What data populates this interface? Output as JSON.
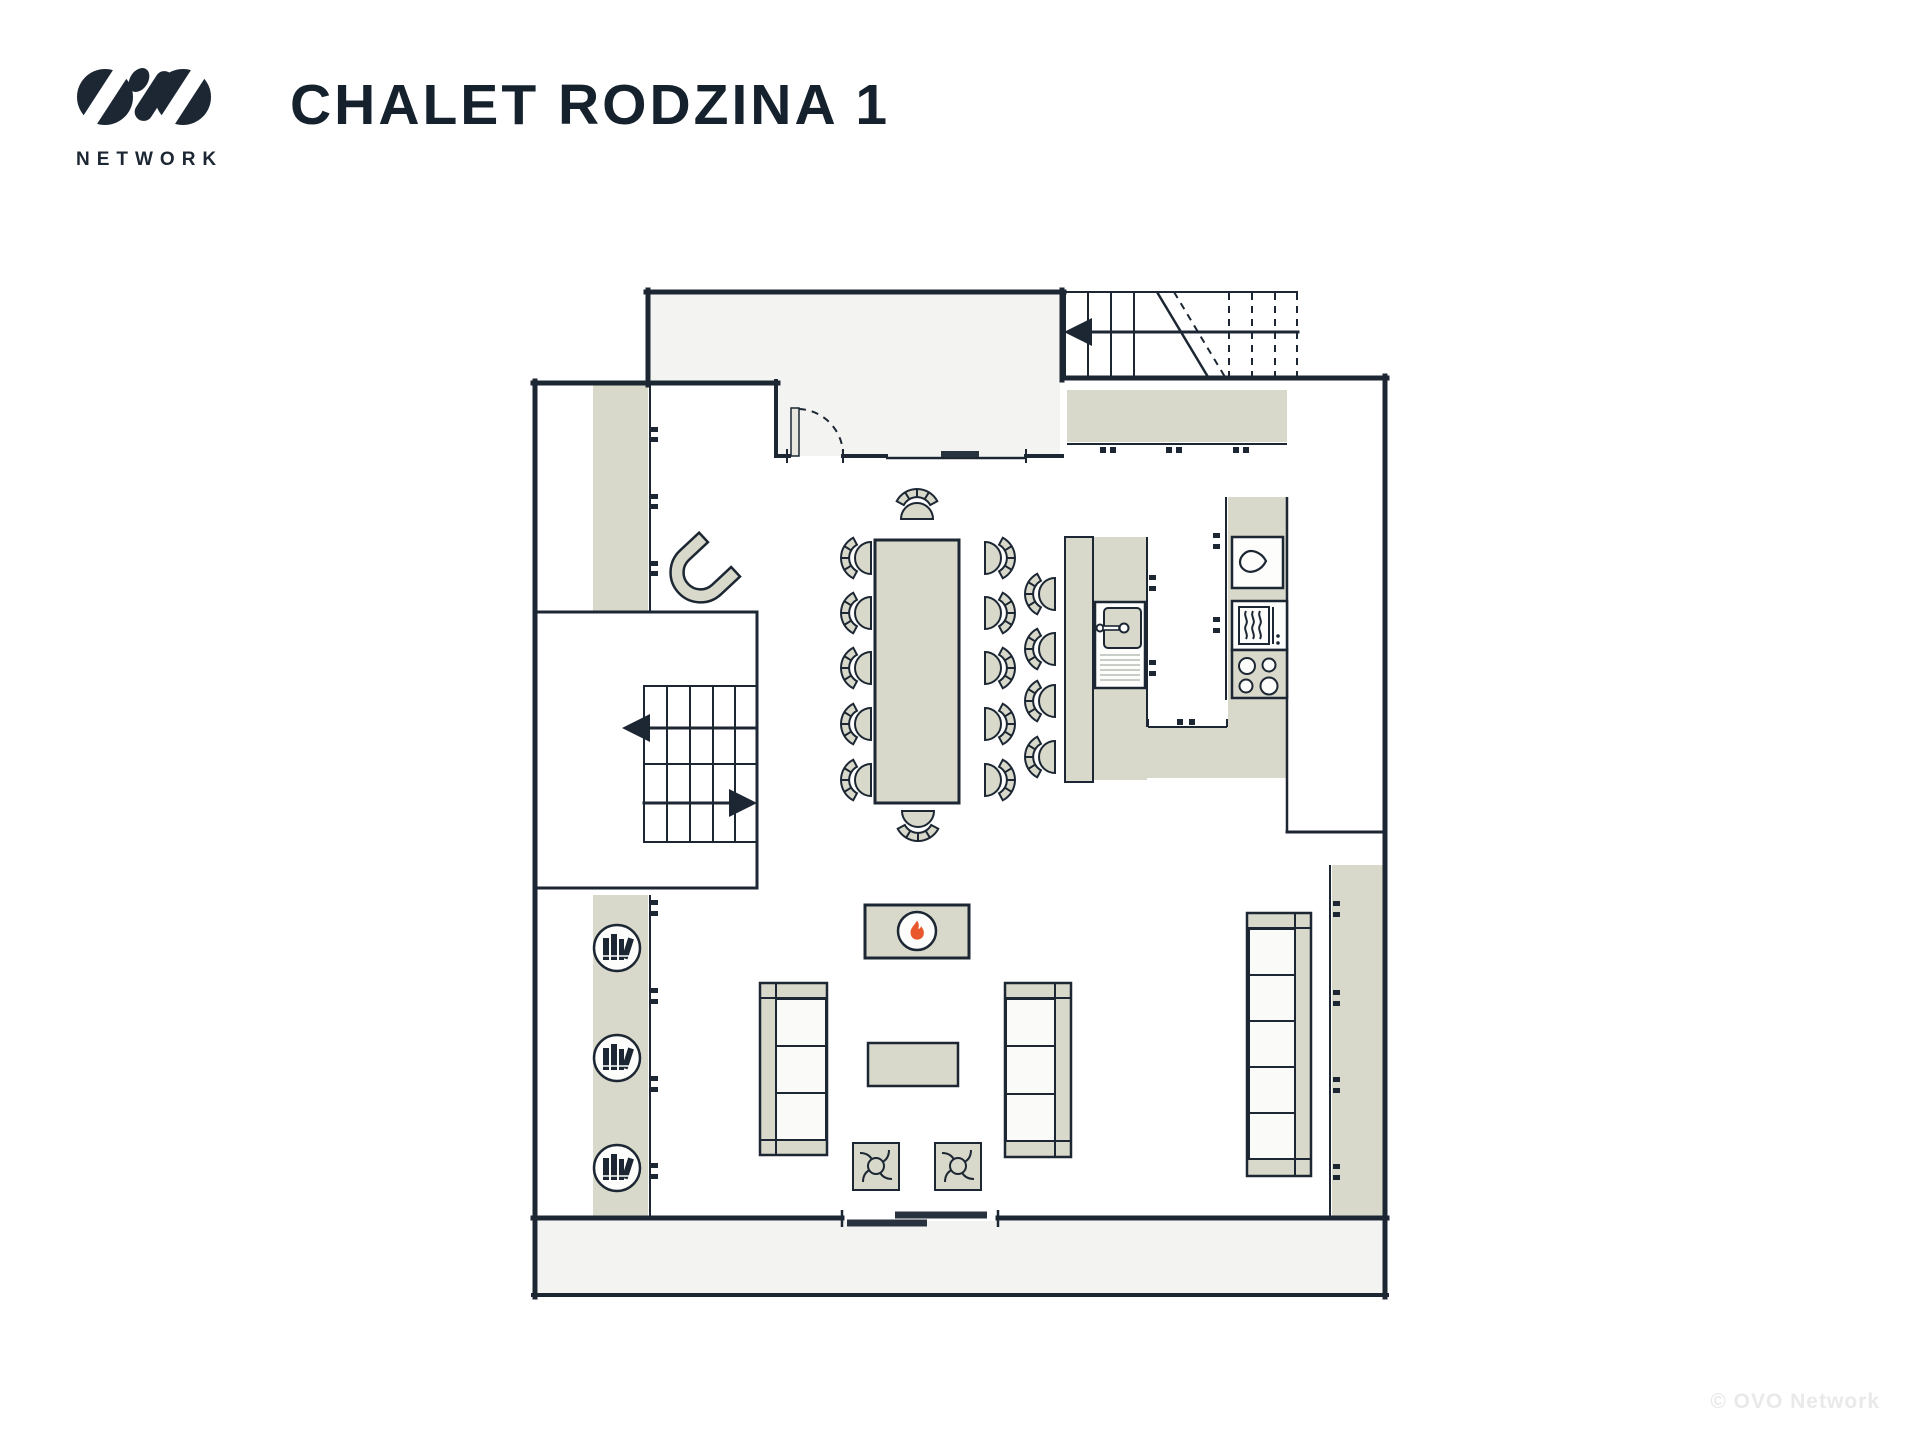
{
  "header": {
    "logo_brand": "OVO",
    "logo_subtitle": "NETWORK",
    "title": "CHALET RODZINA 1"
  },
  "watermark": "© OVO Network",
  "colors": {
    "ink": "#1c2733",
    "furniture_beige": "#d8d9ca",
    "room_gray": "#f3f4f2",
    "cushion_white": "#fafbf9",
    "flame_orange": "#e8582c",
    "paper": "#ffffff",
    "drainer_gray": "#c9cdc7",
    "door_leaf": "#e7e7e0"
  },
  "icons": {
    "logo-mark-icon": "two slashed ovals with comma glyph",
    "flame-icon": "fire in circle (fireplace)",
    "books-icon": "book spines in circle (bookshelf)",
    "water-drop-icon": "drop (kitchen tall unit)",
    "heat-waves-icon": "oven",
    "burners-icon": "4-ring hob",
    "sink-icon": "basin with tap and drainer",
    "stair-arrow-icon": "direction of stairs",
    "door-swing-icon": "entry door arc",
    "sliding-door-icon": "overlapping panels",
    "pouf-swirl-icon": "stitched pouf top"
  }
}
